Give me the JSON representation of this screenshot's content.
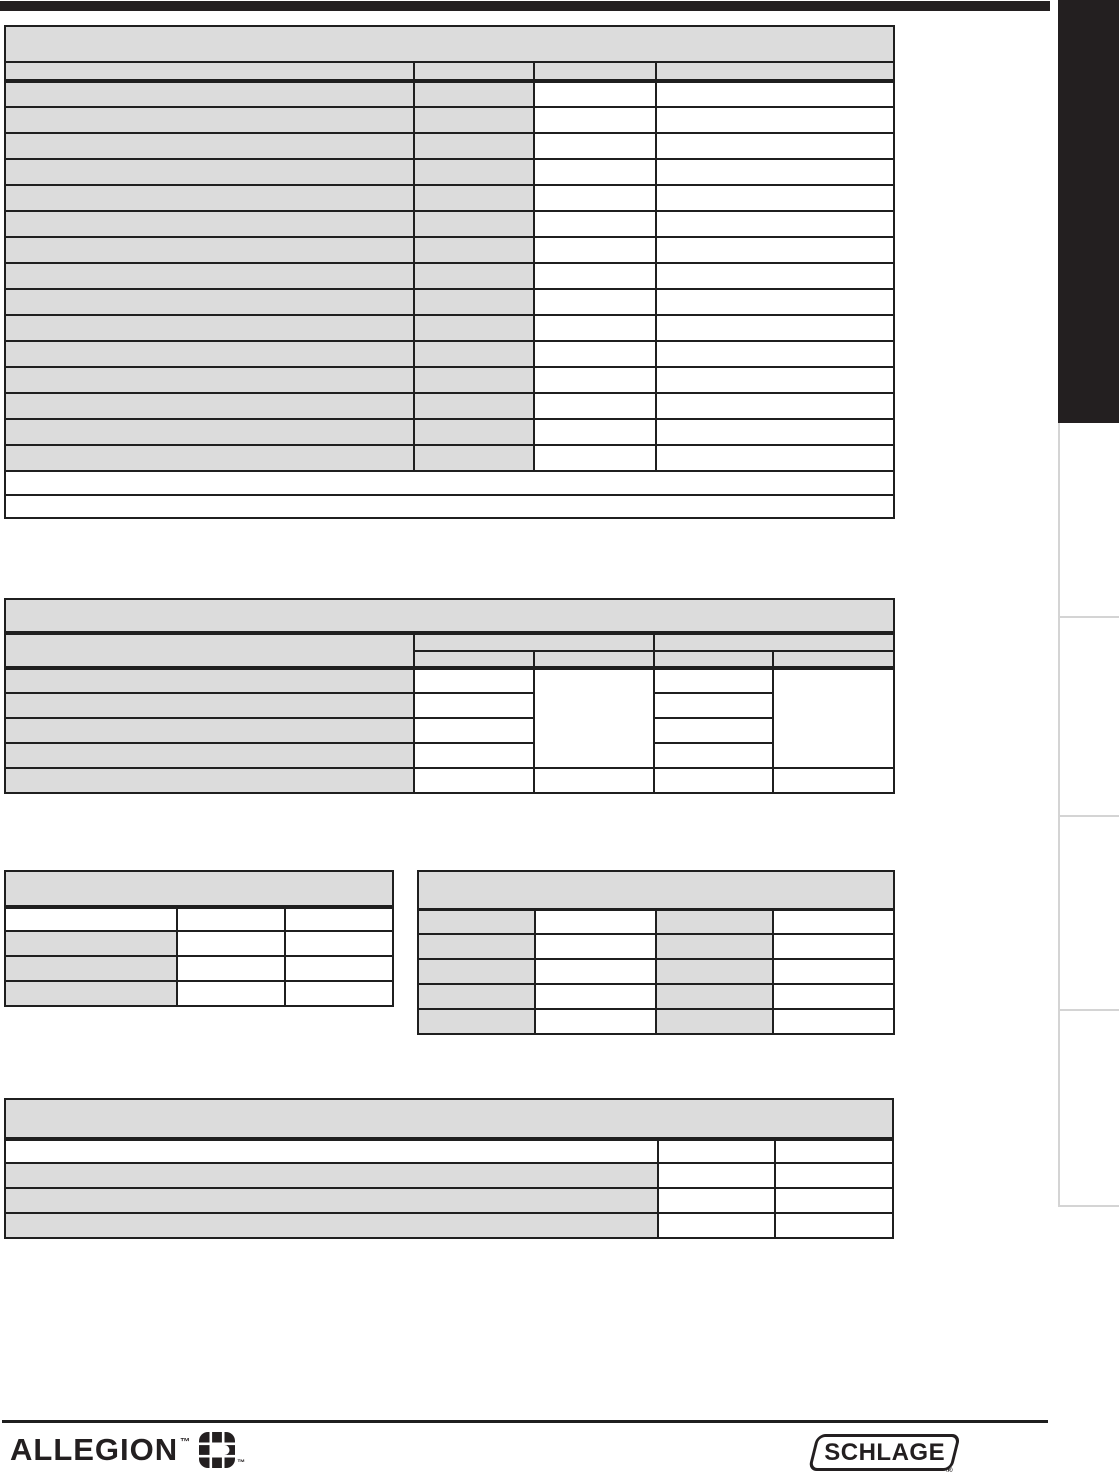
{
  "page": {
    "width": 1119,
    "height": 1472,
    "background_color": "#ffffff"
  },
  "colors": {
    "table_shade": "#dcdcdc",
    "table_border": "#1f1f1f",
    "ink": "#231f20",
    "sidebar_tab_divider": "#d4d4d4"
  },
  "top_bar": {
    "color": "#231f20"
  },
  "right_sidebar": {
    "active_tab_color": "#231f20",
    "inactive_tab_count": 4
  },
  "tables": {
    "table_1": {
      "columns": 4,
      "header_rows": 1,
      "data_rows": 15,
      "footnote_rows": 2
    },
    "table_2": {
      "columns": 5,
      "header_rows": 2,
      "data_rows": 5
    },
    "table_3": {
      "columns": 3,
      "header_rows": 1,
      "data_rows": 3
    },
    "table_4": {
      "columns": 4,
      "header_rows": 0,
      "data_rows": 5
    },
    "table_5": {
      "columns": 3,
      "header_rows": 0,
      "data_rows": 4
    }
  },
  "footer": {
    "allegion": {
      "wordmark": "ALLEGION",
      "trademark_symbol": "™"
    },
    "schlage": {
      "wordmark": "SCHLAGE",
      "registered_symbol": "®"
    }
  }
}
